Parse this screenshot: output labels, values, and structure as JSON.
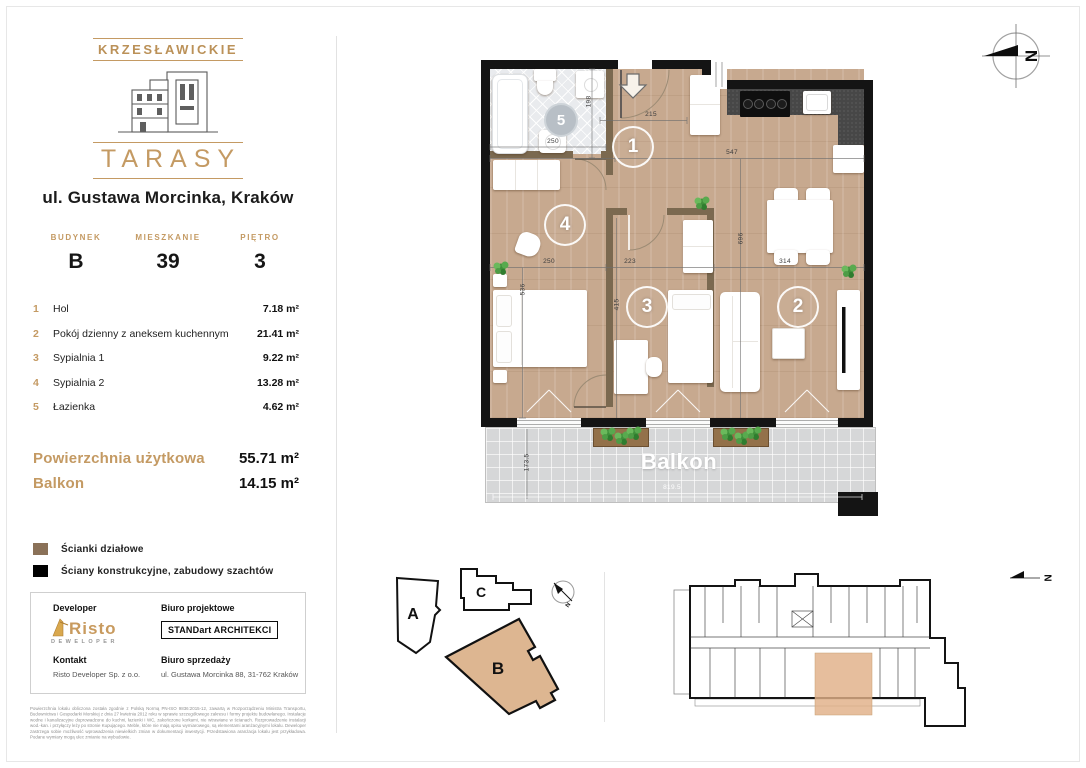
{
  "accent": "#c49a63",
  "logo": {
    "top": "KRZESŁAWICKIE",
    "bottom": "TARASY"
  },
  "address": "ul. Gustawa Morcinka, Kraków",
  "unit": {
    "building_label": "BUDYNEK",
    "building_value": "B",
    "apartment_label": "MIESZKANIE",
    "apartment_value": "39",
    "floor_label": "PIĘTRO",
    "floor_value": "3"
  },
  "rooms": [
    {
      "no": "1",
      "name": "Hol",
      "area": "7.18 m²"
    },
    {
      "no": "2",
      "name": "Pokój dzienny z aneksem kuchennym",
      "area": "21.41 m²"
    },
    {
      "no": "3",
      "name": "Sypialnia 1",
      "area": "9.22 m²"
    },
    {
      "no": "4",
      "name": "Sypialnia 2",
      "area": "13.28 m²"
    },
    {
      "no": "5",
      "name": "Łazienka",
      "area": "4.62 m²"
    }
  ],
  "totals": {
    "usable_label": "Powierzchnia użytkowa",
    "usable_value": "55.71 m²",
    "balcony_label": "Balkon",
    "balcony_value": "14.15 m²"
  },
  "legend": [
    {
      "color": "#8a7158",
      "label": "Ścianki działowe"
    },
    {
      "color": "#000000",
      "label": "Ściany konstrukcyjne, zabudowy szachtów"
    }
  ],
  "developer_box": {
    "developer_label": "Developer",
    "developer_logo_main": "Risto",
    "developer_logo_sub": "DEWELOPER",
    "design_office_label": "Biuro projektowe",
    "design_office_name": "STANDart ARCHITEKCI",
    "contact_label": "Kontakt",
    "contact_value": "Risto Developer Sp. z o.o.",
    "sales_label": "Biuro sprzedaży",
    "sales_value": "ul. Gustawa Morcinka 88, 31-762 Kraków"
  },
  "disclaimer": "Powierzchnia lokalu obliczona została zgodnie z Polską Normą PN-ISO 9836:2015-12, zawartą w Rozporządzeniu Ministra Transportu, Budownictwa i Gospodarki Morskiej z dnia 27 kwietnia 2012 roku w sprawie szczegółowego zakresu i formy projektu budowlanego. Instalacje wodne i kanalizacyjne doprowadzone do kuchni, łazienki i WC, zakończone korkami, nie wtrawiane w ścianach. Rozprowadzenie instalacji wod.-kan. i przyłączy leży po stronie Kupującego. Meble, które nie mają opisu wymiarowego, są elementami aranżacyjnymi lokalu. Deweloper zastrzega sobie możliwość wprowadzenia niewielkich zmian w dokumentacji inwestycji. Przedstawiona aranżacja lokalu jest przykładowa. Podane wymiary mogą ulec zmianie na wybudowie.",
  "plan": {
    "balcony_label": "Balkon",
    "north_letter": "N",
    "room_numbers": {
      "r1": "1",
      "r2": "2",
      "r3": "3",
      "r4": "4",
      "r5": "5"
    },
    "dims": {
      "d215": "215",
      "d547": "547",
      "d198": "198",
      "d250_bath": "250",
      "d250": "250",
      "d223": "223",
      "d314": "314",
      "d536": "536",
      "d415": "415",
      "d696": "696",
      "d173_5": "173.5",
      "d819_5": "819.5"
    }
  },
  "site_plan": {
    "a": "A",
    "b": "B",
    "c": "C"
  }
}
